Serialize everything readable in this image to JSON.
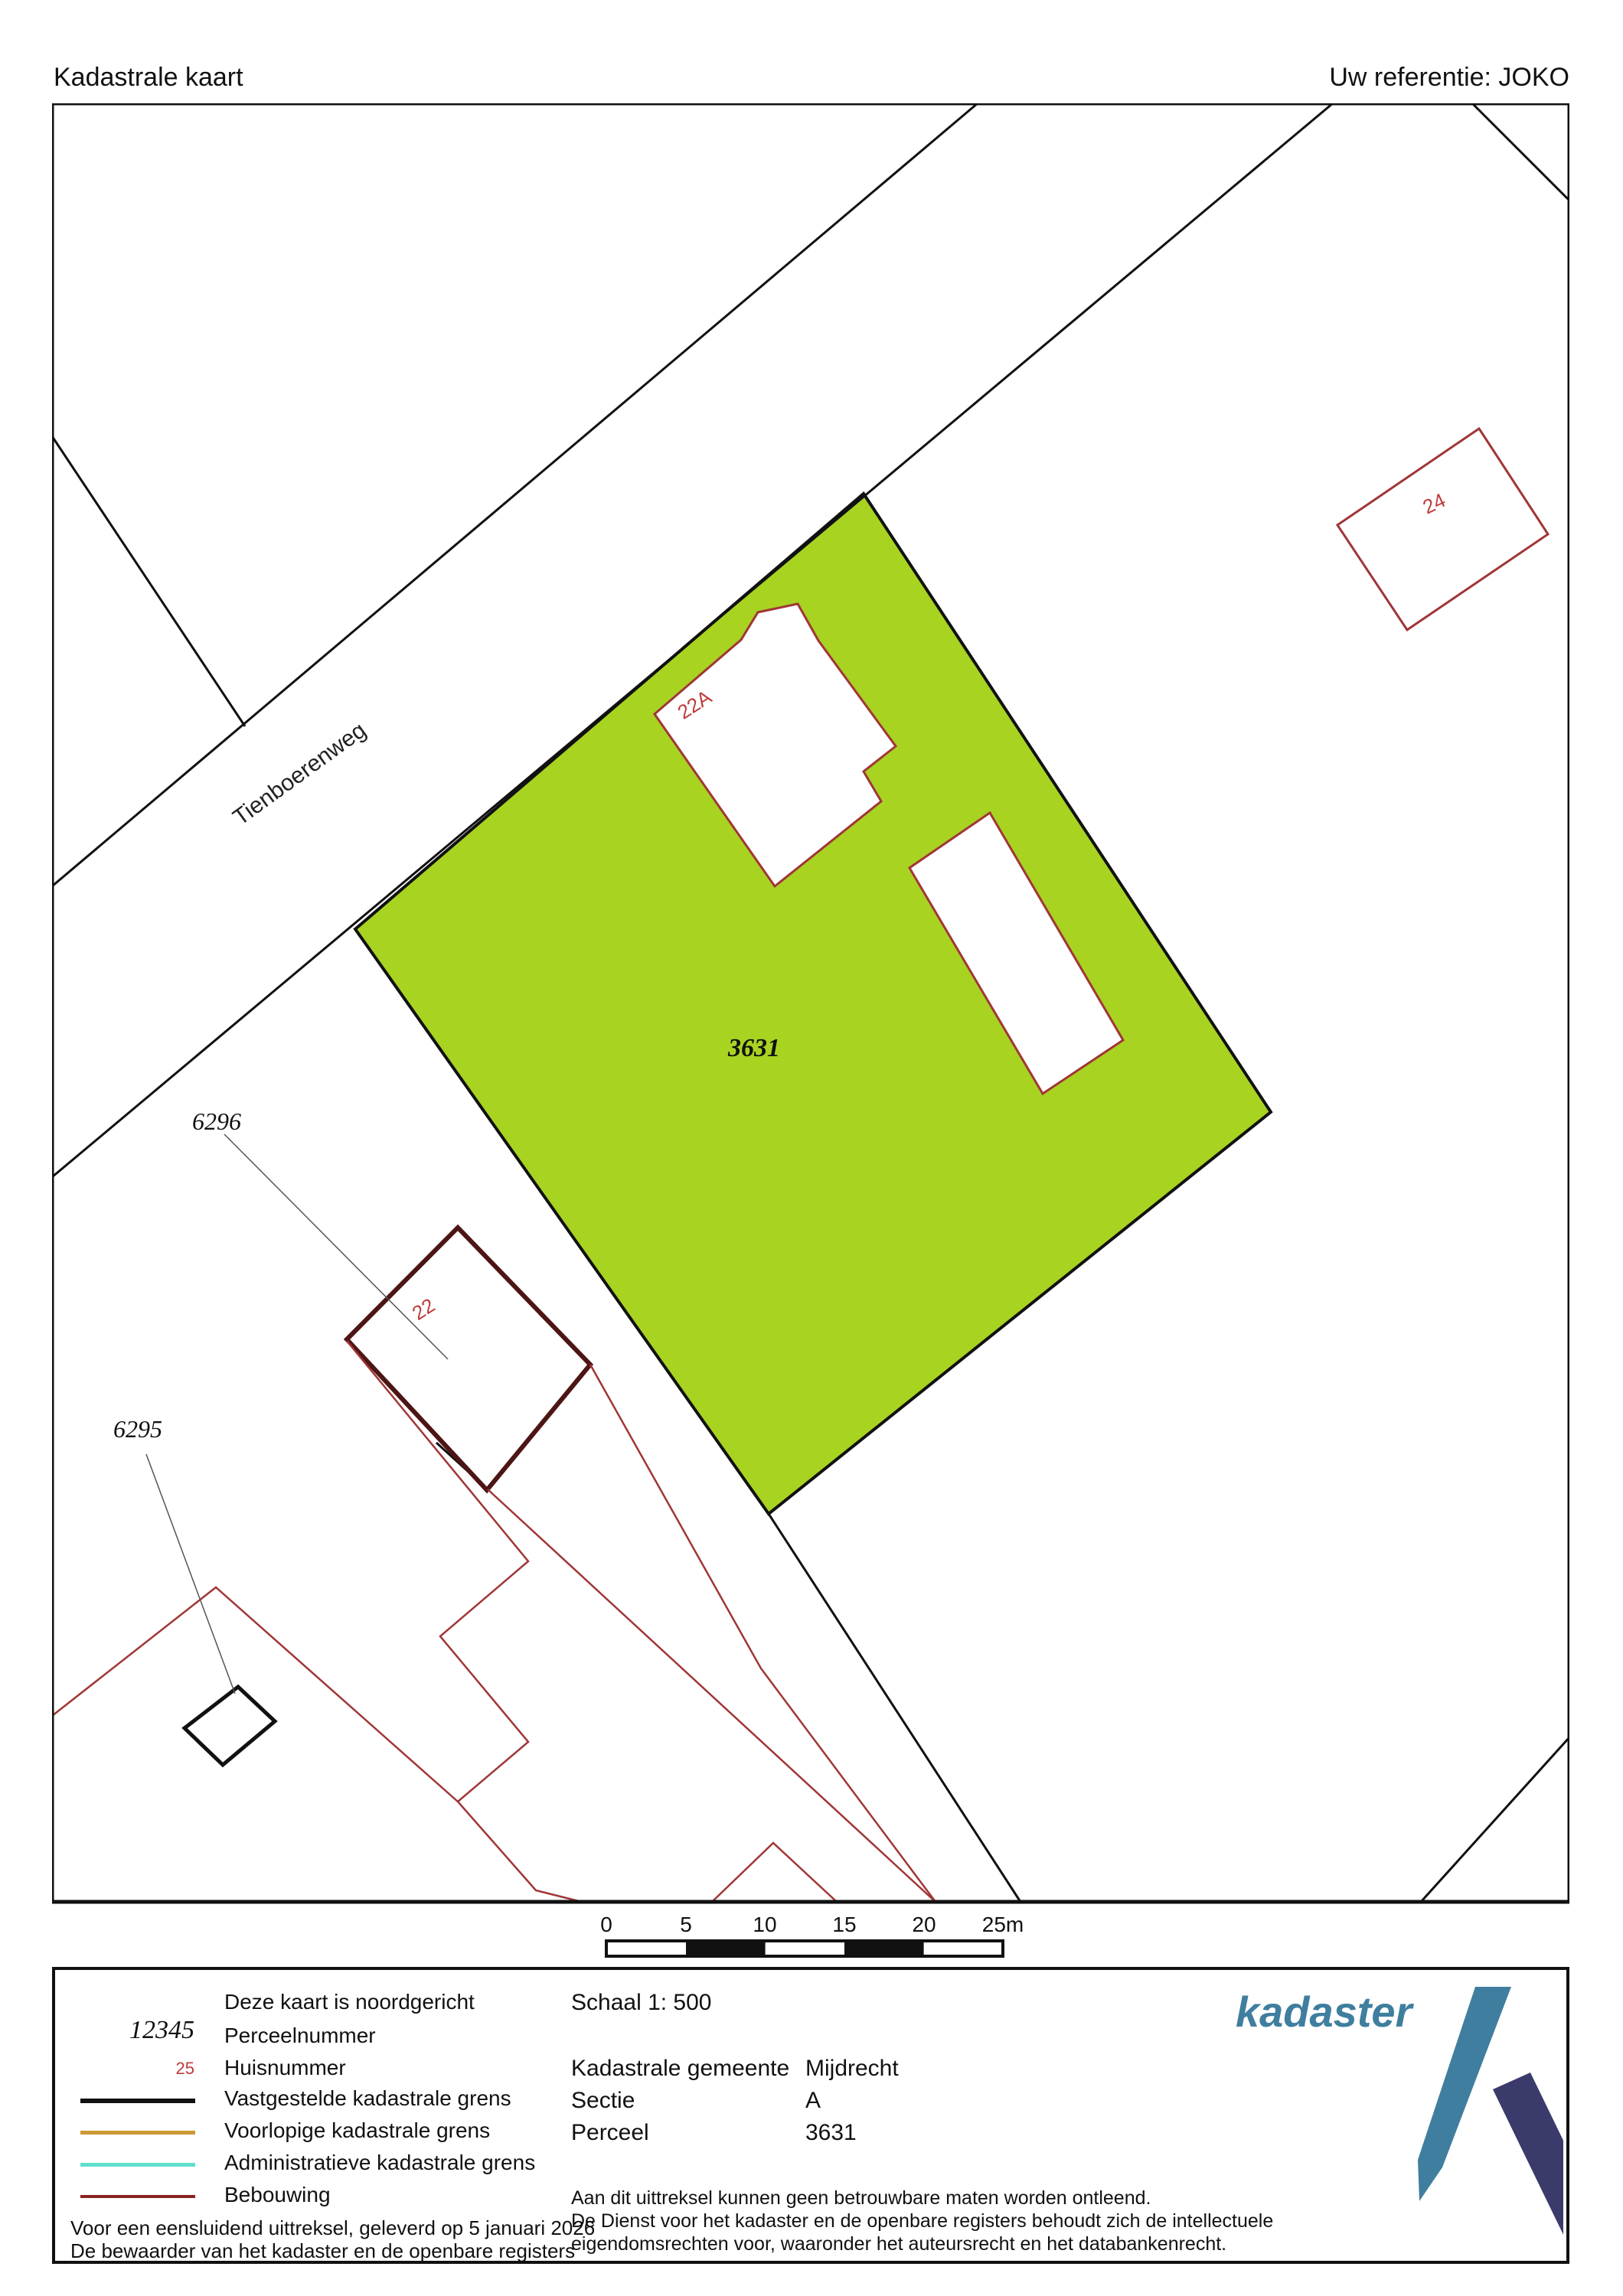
{
  "header": {
    "title": "Kadastrale kaart",
    "reference": "Uw referentie: JOKO"
  },
  "map": {
    "road_label": "Tienboerenweg",
    "highlight_parcel_number": "3631",
    "parcel_number_6296": "6296",
    "parcel_number_6295": "6295",
    "house_number_22a": "22A",
    "house_number_22": "22",
    "house_number_24": "24"
  },
  "scale_bar": {
    "ticks": [
      "0",
      "5",
      "10",
      "15",
      "20",
      "25m"
    ]
  },
  "legend": {
    "north_note": "Deze kaart is noordgericht",
    "perceel_symbol": "12345",
    "perceel_label": "Perceelnummer",
    "huis_symbol": "25",
    "huis_label": "Huisnummer",
    "vastgesteld_label": "Vastgestelde kadastrale grens",
    "voorlopig_label": "Voorlopige kadastrale grens",
    "administratief_label": "Administratieve kadastrale grens",
    "bebouwing_label": "Bebouwing",
    "footer_line1": "Voor een eensluidend uittreksel, geleverd op 5 januari 2026",
    "footer_line2": "De bewaarder van het kadaster en de openbare registers"
  },
  "details": {
    "schaal": "Schaal 1: 500",
    "gemeente_label": "Kadastrale gemeente",
    "gemeente_value": "Mijdrecht",
    "sectie_label": "Sectie",
    "sectie_value": "A",
    "perceel_label": "Perceel",
    "perceel_value": "3631",
    "disclaimer_line1": "Aan dit uittreksel kunnen geen betrouwbare maten worden ontleend.",
    "disclaimer_line2": "De Dienst voor het kadaster en de openbare registers behoudt zich de intellectuele",
    "disclaimer_line3": "eigendomsrechten voor, waaronder het auteursrecht en het databankenrecht."
  },
  "logo": {
    "text": "kadaster"
  },
  "colors": {
    "highlight_parcel_fill": "#a8d321",
    "boundary_black": "#111111",
    "bebouwing_outline": "#a03636",
    "bebouwing_dark_outline": "#4d1515",
    "house_number_red": "#bf3a3a",
    "voorlopige_grens": "#cc9933",
    "administratieve_grens": "#5fe0cd",
    "logo_teal": "#3f7e9e",
    "logo_navy": "#3a3a6b"
  }
}
